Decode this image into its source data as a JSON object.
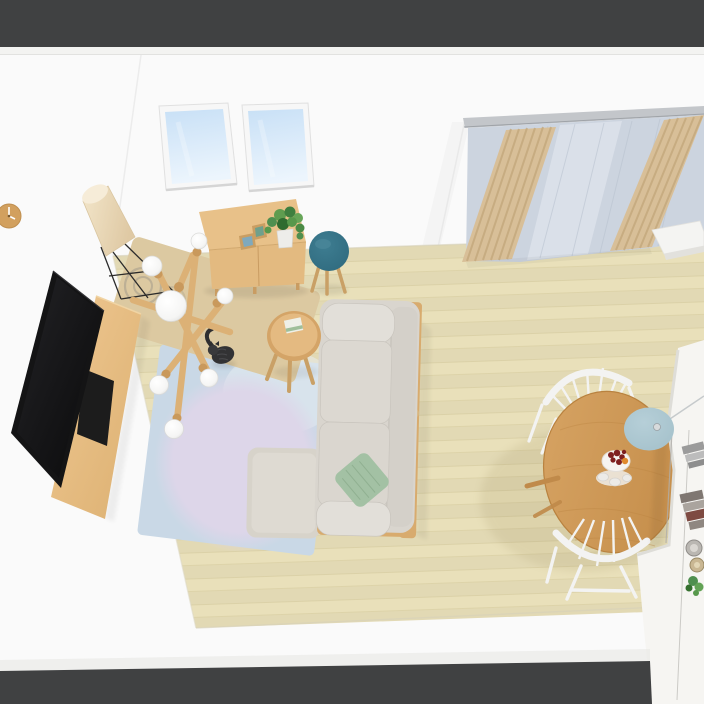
{
  "scene": {
    "title": "Top-down 3D render of a living-dining room",
    "view": "elevated isometric interior view, no UI chrome",
    "room": {
      "walls": "white plaster",
      "floor": "light beige wood planks",
      "outside_frame": "dark gray band at top and bottom edges"
    },
    "objects": [
      {
        "name": "wall-clock",
        "desc": "round wooden wall clock on left wall",
        "color": "#d2a05e"
      },
      {
        "name": "skylight",
        "count": 2,
        "desc": "two roof windows with blue sky",
        "color": "#c8e0f6"
      },
      {
        "name": "curtains",
        "desc": "tan pleated drapes with gray sheer on right wall rail",
        "colors": [
          "#d8bf98",
          "#ccd4df"
        ]
      },
      {
        "name": "floor-lamp",
        "desc": "tilted paper cone shade on black wire tripod",
        "color": "#e7d3b3"
      },
      {
        "name": "sideboard",
        "desc": "light oak cabinet with two picture frames and potted ivy",
        "color": "#e3ba80"
      },
      {
        "name": "stool",
        "desc": "round teal stool with wood legs",
        "color": "#2f6a7e"
      },
      {
        "name": "tv",
        "desc": "large black flat screen on oak media console",
        "color": "#141415"
      },
      {
        "name": "tv-console",
        "desc": "long oak TV bench with black open shelf",
        "color": "#e3ba80"
      },
      {
        "name": "sputnik-chandelier",
        "desc": "wooden-arm chandelier with 7 white globe bulbs",
        "colors": [
          "#dcb176",
          "#ffffff"
        ]
      },
      {
        "name": "tan-rug",
        "desc": "angled beige runner rug with ring motif",
        "color": "#dcc9a1"
      },
      {
        "name": "cat",
        "desc": "dark gray cat sitting on the tan rug",
        "color": "#323234"
      },
      {
        "name": "side-table",
        "desc": "small round wood table with open book",
        "color": "#e0b478"
      },
      {
        "name": "blue-rug",
        "desc": "large light blue rug with lavender circle",
        "colors": [
          "#c9d8e6",
          "#ddd6e9"
        ]
      },
      {
        "name": "sofa",
        "desc": "light gray 3-seat sofa, wood frame, sage green cushion",
        "colors": [
          "#d9d5ce",
          "#a3c1a4"
        ]
      },
      {
        "name": "ottoman",
        "desc": "square light gray ottoman beside chaise",
        "color": "#d7d3ca"
      },
      {
        "name": "dining-table",
        "desc": "round oak dining table with dessert plate and cups",
        "color": "#d09b58"
      },
      {
        "name": "dining-chair",
        "count": 2,
        "desc": "white spindle-back chairs",
        "color": "#f3f3f2"
      },
      {
        "name": "pendant-lamp",
        "desc": "muted blue disc pendant on cord over table",
        "color": "#a3c0ca"
      },
      {
        "name": "dessert-plate",
        "desc": "white plate with red berries and orange slice, espresso cups",
        "colors": [
          "#7e1f1f",
          "#e08a2e"
        ]
      },
      {
        "name": "kitchen-island",
        "desc": "white counter at right edge with book stacks, canisters, plant",
        "color": "#f6f5f2"
      },
      {
        "name": "window-sill-box",
        "desc": "white sill unit below curtain",
        "color": "#f4f4f2"
      }
    ]
  },
  "palette": {
    "band_dark": "#404142",
    "wall": "#fafafa",
    "wall_trim": "#f3f3f1",
    "floor": "#e9e0ba",
    "floor_line": "#cdc394",
    "sky_top": "#c8e0f6",
    "sky_bottom": "#ecf5fd",
    "frame_white": "#f7f7f7",
    "clock_wood": "#d2a05e",
    "curtain_rail": "#c3c6ca",
    "curtain_tan": "#d8bf98",
    "curtain_tan_dark": "#c0a478",
    "curtain_sheer": "#ccd4df",
    "curtain_sheer_light": "#e2e7ee",
    "wood": "#e3ba80",
    "wood_dark": "#c99c62",
    "wood_side": "#d8ab6e",
    "table_wood": "#d09b58",
    "table_wood_dark": "#bd894a",
    "tv_black": "#141415",
    "sofa": "#d9d5ce",
    "sofa_light": "#e2dfd9",
    "sofa_shadow": "#c7c3bc",
    "green_cushion": "#a3c1a4",
    "green_cushion_dark": "#90b091",
    "ottoman": "#d7d3ca",
    "ottoman_light": "#dedad2",
    "rug_blue": "#c9d8e6",
    "rug_lavender": "#ddd6e9",
    "rug_tan": "#dcc9a1",
    "rug_ring": "#9d978a",
    "teal": "#2f6a7e",
    "pendant": "#a3c0ca",
    "lamp_shade": "#e7d3b3",
    "chair_white": "#f3f3f2",
    "counter": "#f6f5f2",
    "counter_edge": "#deddd8",
    "seam": "#b0aeaa",
    "plant": "#4f8f4f",
    "pot": "#ededea",
    "cat": "#323234",
    "berry": "#7e1f1f",
    "orange_fruit": "#e08a2e",
    "plate": "#f6f4f1"
  }
}
